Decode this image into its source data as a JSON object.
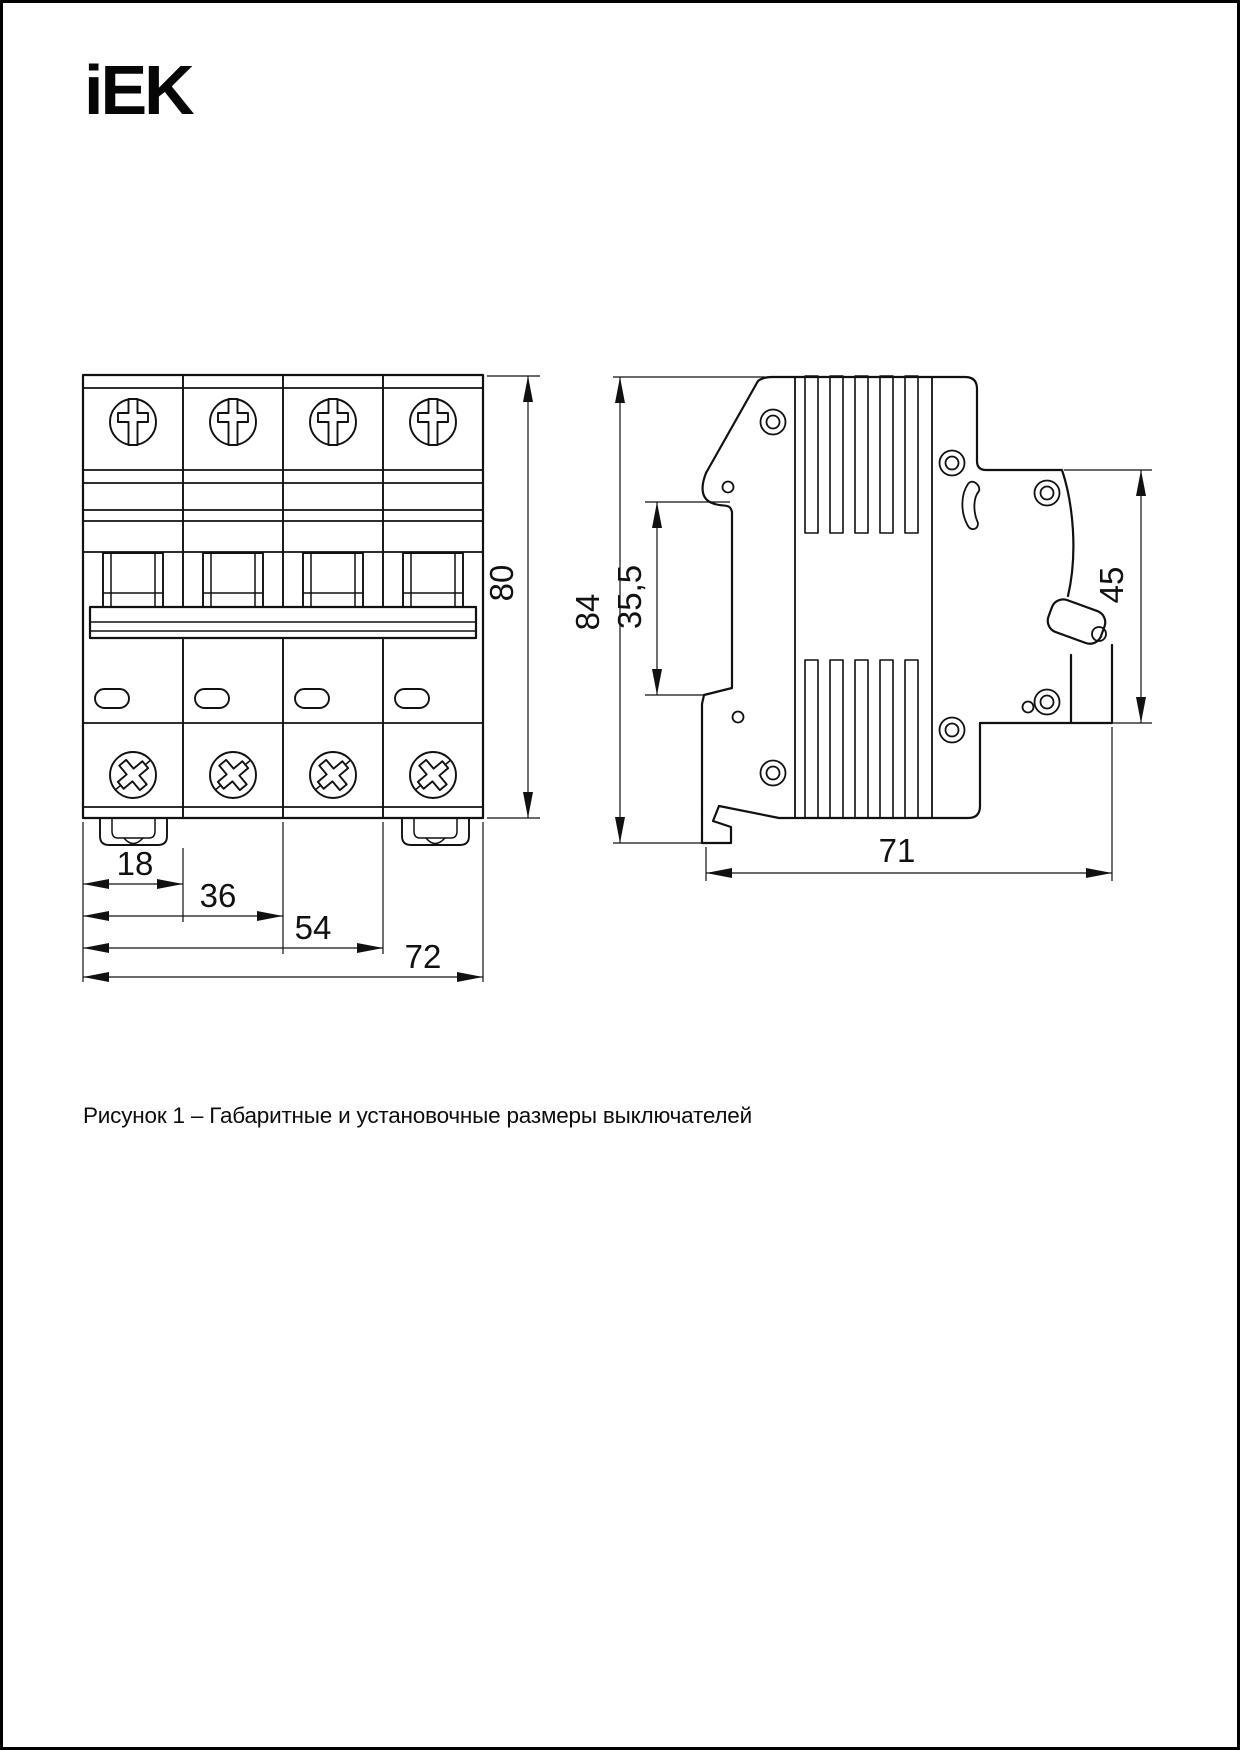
{
  "page": {
    "background": "#ffffff",
    "border_color": "#000000"
  },
  "logo": {
    "text": "iEK",
    "color": "#060606"
  },
  "caption": {
    "text": "Рисунок 1 – Габаритные и установочные размеры выключателей"
  },
  "figure": {
    "title": "Габаритные и установочные размеры выключателей",
    "front_view": {
      "description": "four-pole circuit breaker front view",
      "modules": 4,
      "dimensions_mm": {
        "module_width": "18",
        "two_modules": "36",
        "three_modules": "54",
        "total_width": "72",
        "height": "80"
      }
    },
    "side_view": {
      "description": "circuit breaker side view with DIN rail mount",
      "dimensions_mm": {
        "height": "84",
        "din_channel_offset": "35,5",
        "upper_depth": "45",
        "total_depth": "71"
      }
    }
  },
  "dimension_labels": {
    "d18": "18",
    "d36": "36",
    "d54": "54",
    "d72": "72",
    "d80": "80",
    "d84": "84",
    "d355": "35,5",
    "d45": "45",
    "d71": "71"
  }
}
